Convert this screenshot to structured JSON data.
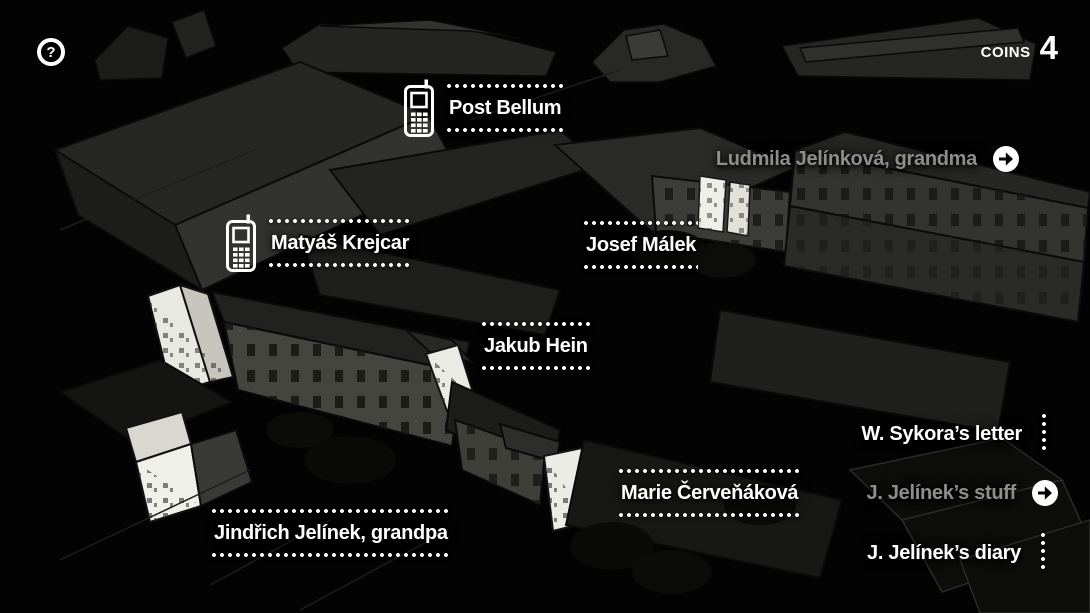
{
  "hud": {
    "help_glyph": "?",
    "coins_label": "COINS",
    "coins_value": "4"
  },
  "locations": {
    "post_bellum": "Post Bellum",
    "matyas_krejcar": "Matyáš Krejcar",
    "josef_malek": "Josef Málek",
    "ludmila_jelinkova": "Ludmila Jelínková, grandma",
    "jakub_hein": "Jakub Hein",
    "marie_cervenakova": "Marie Červeňáková",
    "jindrich_jelinek": "Jindřich Jelínek, grandpa",
    "w_sykora_letter": "W. Sykora’s letter",
    "j_jelinek_stuff": "J. Jelínek’s stuff",
    "j_jelinek_diary": "J. Jelínek’s diary"
  },
  "icons": {
    "help": "question-mark-icon",
    "phone": "phone-icon",
    "arrow_right": "arrow-right-icon",
    "dotted_separator": "dotted-line"
  },
  "colors": {
    "background": "#000000",
    "label_active": "#ffffff",
    "label_visited": "#8d8d8d",
    "lit_facade": "#ecece6",
    "building_gray": "#45453f"
  }
}
